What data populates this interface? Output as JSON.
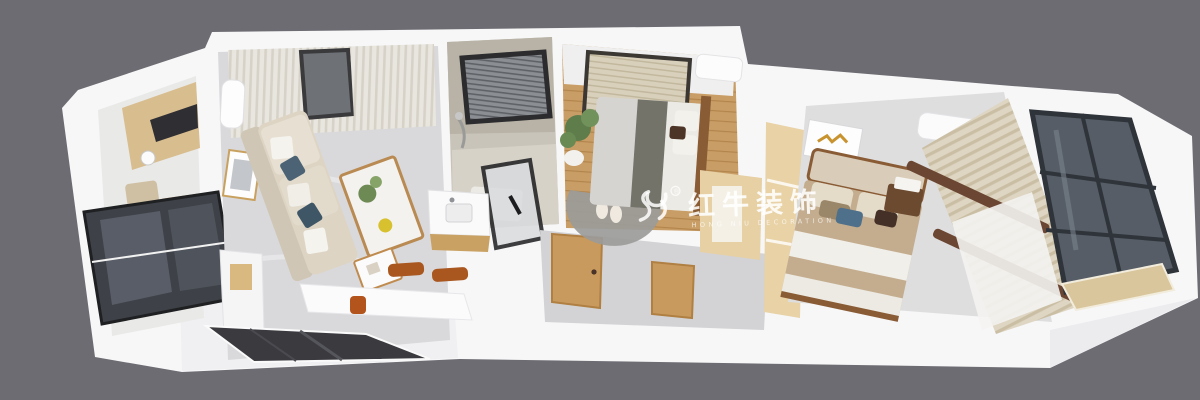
{
  "image": {
    "type": "3d-dollhouse-floorplan-render",
    "description": "aerial cutaway render of a long apartment, white walls, gray backdrop",
    "background_color": "#6c6c72"
  },
  "watermark": {
    "logo": "bull-icon",
    "registered_mark": "®",
    "brand": "红牛装饰",
    "subtitle": "HONG NIU DECORATION",
    "color": "#ffffff"
  },
  "palette": {
    "backdrop": "#6c6c72",
    "wall_white": "#f7f7f8",
    "wall_shade": "#ededf0",
    "tile_floor": "#d9d9db",
    "wood_floor": "#c99e66",
    "cabinet_wood": "#e6d0a4",
    "counter_wood": "#d8bd8f",
    "door_wood": "#c99a5e",
    "dark_glass": "#565d66",
    "entry_door": "#3a3a3f",
    "sofa_beige": "#ddd4c4",
    "pillow_blue": "#4b6374",
    "chair_brown": "#a9571f",
    "bedding_olive": "#73736a",
    "bed_beige": "#c4ad8f",
    "curtain_light": "#e9e6df",
    "curtain_beige": "#ded5c2",
    "curtain_rod_brown": "#6b4632",
    "rug_gray": "#9b9b99",
    "plant_green": "#5e7d4b",
    "bath_tile": "#c9c4ba"
  },
  "rooms": [
    {
      "name": "kitchen",
      "furniture": [
        "wood-countertop",
        "cooktop",
        "sink",
        "water-purifier",
        "dark-glass-partition"
      ]
    },
    {
      "name": "living-dining-room",
      "furniture": [
        "curtains",
        "window",
        "wall-ac-unit",
        "wall-art",
        "sofa",
        "throw-pillows",
        "coffee-table",
        "side-table",
        "dining-table",
        "dining-chairs",
        "sideboard"
      ]
    },
    {
      "name": "bathroom",
      "furniture": [
        "window-blinds",
        "shower",
        "glass-door",
        "vanity-sink"
      ]
    },
    {
      "name": "hallway",
      "furniture": [
        "wood-door",
        "wood-door",
        "wood-cabinet",
        "entry-door"
      ]
    },
    {
      "name": "second-bedroom",
      "furniture": [
        "window-blinds",
        "ac-unit",
        "bed",
        "headboard",
        "plant",
        "round-rug",
        "slippers",
        "wardrobe-desk"
      ]
    },
    {
      "name": "closet-strip",
      "furniture": [
        "tall-cabinets"
      ]
    },
    {
      "name": "master-bedroom",
      "furniture": [
        "wall-art",
        "ac-unit",
        "bed",
        "pillows",
        "nightstand",
        "books",
        "curtains",
        "curtain-rods"
      ]
    },
    {
      "name": "balcony-window-wall",
      "furniture": [
        "dark-glass-panes",
        "window-sill"
      ]
    }
  ]
}
